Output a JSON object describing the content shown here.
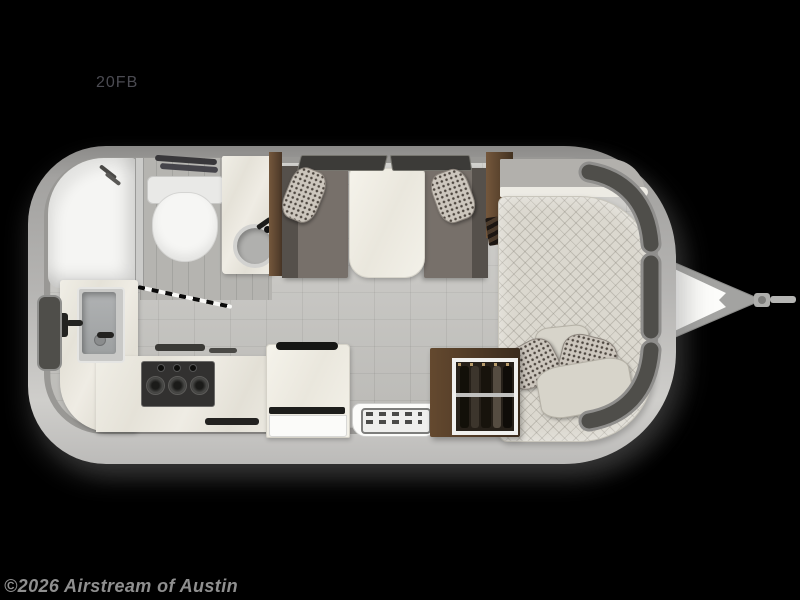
{
  "title": {
    "label": "20FB"
  },
  "watermark": {
    "label": "©2026 Airstream of Austin"
  },
  "floorplan": {
    "model": "20FB",
    "type": "travel-trailer-floorplan",
    "areas": [
      "rear-bathroom",
      "galley-kitchen",
      "dinette",
      "front-bedroom"
    ],
    "fixtures": [
      "shower",
      "toilet",
      "vanity-sink",
      "roof-vents",
      "kitchen-sink",
      "kitchen-faucet",
      "cooktop",
      "refrigerator",
      "entry-step",
      "wardrobe-closet",
      "dinette-bench-left",
      "dinette-bench-right",
      "dinette-table",
      "bed",
      "pillows",
      "front-wrap-windows",
      "hitch-tongue"
    ]
  },
  "colors": {
    "background": "#000000",
    "title": "#4b4b52",
    "watermark": "#8f8f8f",
    "shell": "#b5b4b2",
    "floor": "#c6c5c1",
    "bath_floor": "#b5b4b0",
    "marble": "#eae7de",
    "wood_dark": "#4a3727",
    "wood_light": "#74573c",
    "bench": "#77706a",
    "bench_dark": "#55504b",
    "mattress": "#dbd8cf",
    "pillow_plain": "#d7d4ca",
    "pillow_pattern_base": "#ccc6bd",
    "window_glass": "#4f4e4a",
    "white_fixture": "#f5f5f3",
    "steel": "#b4b6b7",
    "hitch_frame": "#a3a3a1"
  }
}
